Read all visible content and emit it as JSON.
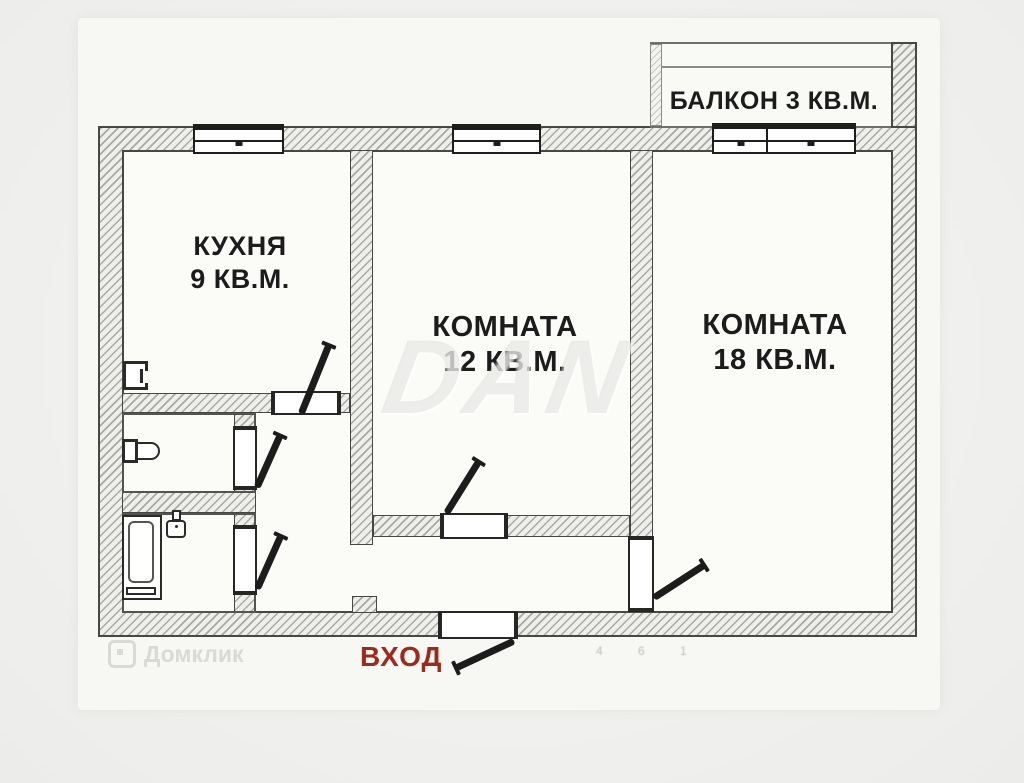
{
  "plan": {
    "balcony_label": "БАЛКОН 3 КВ.М.",
    "entrance_label": "ВХОД",
    "rooms": [
      {
        "name": "КУХНЯ",
        "area": "9 КВ.М."
      },
      {
        "name": "КОМНАТА",
        "area": "12 КВ.М."
      },
      {
        "name": "КОМНАТА",
        "area": "18 КВ.М."
      }
    ],
    "colors": {
      "entrance_red": "#9d2a1d",
      "ink": "#1c1c1c",
      "wall_outline": "#474745",
      "hatch_line": "#8f8f8d",
      "background": "#f0f0ee",
      "watermark_gray": "#cdcdcb"
    },
    "watermarks": {
      "center": "DAN",
      "bottom_left": "Домклик",
      "faint_marks": "4 6 1"
    },
    "icons": {
      "toilet": "toilet-icon",
      "bathtub": "bathtub-icon",
      "sink": "sink-icon",
      "kitchen_vent": "vent-icon",
      "door_leaf": "door-leaf-icon",
      "window": "window-icon",
      "domklik_logo": "house-logo-icon"
    }
  }
}
